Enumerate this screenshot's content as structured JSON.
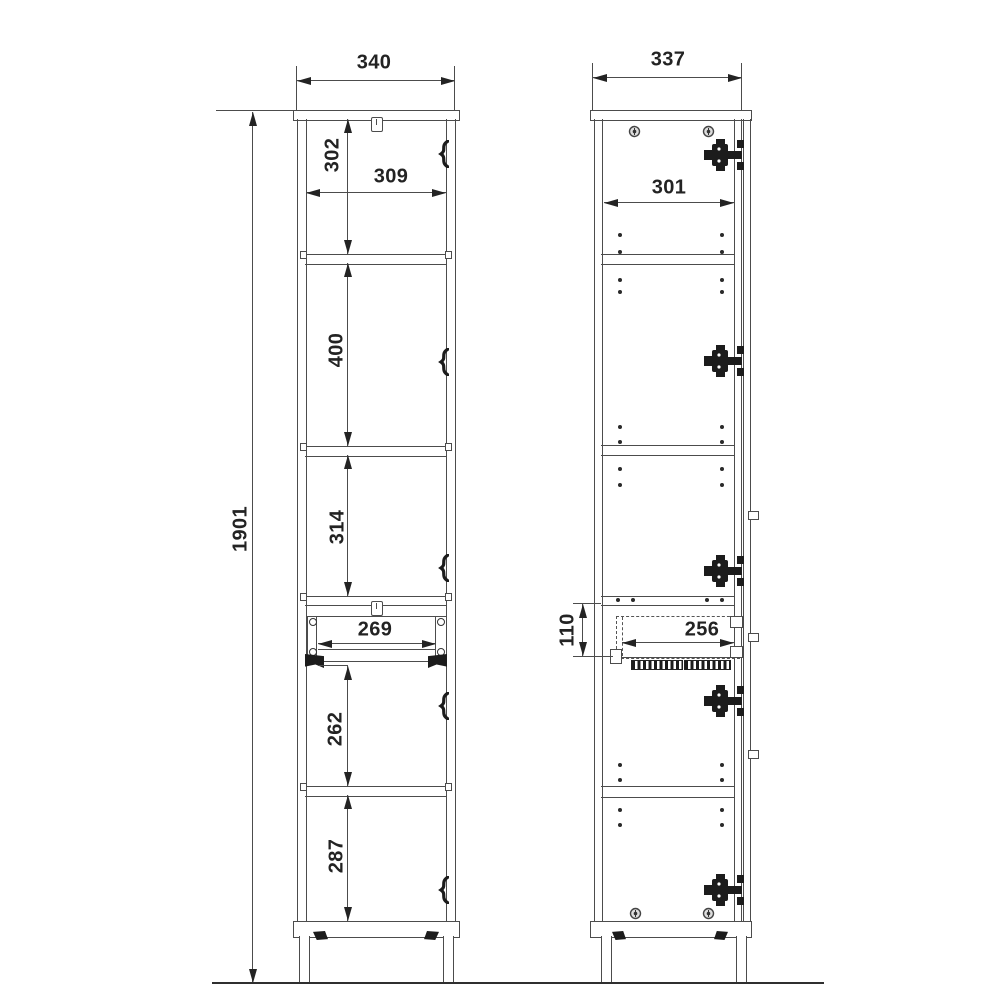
{
  "colors": {
    "line": "#4c4c4c",
    "ink": "#232323",
    "hinge": "#1c1c1c",
    "background": "#ffffff"
  },
  "front_view": {
    "overall_width": "340",
    "overall_height": "1901",
    "top_section_height": "302",
    "interior_width": "309",
    "upper_middle_section_height": "400",
    "lower_middle_section_height": "314",
    "drawer_opening_width": "269",
    "below_drawer_section_height": "262",
    "bottom_section_height": "287"
  },
  "side_view": {
    "overall_depth": "337",
    "interior_depth": "301",
    "drawer_front_height": "110",
    "drawer_interior_depth": "256"
  }
}
